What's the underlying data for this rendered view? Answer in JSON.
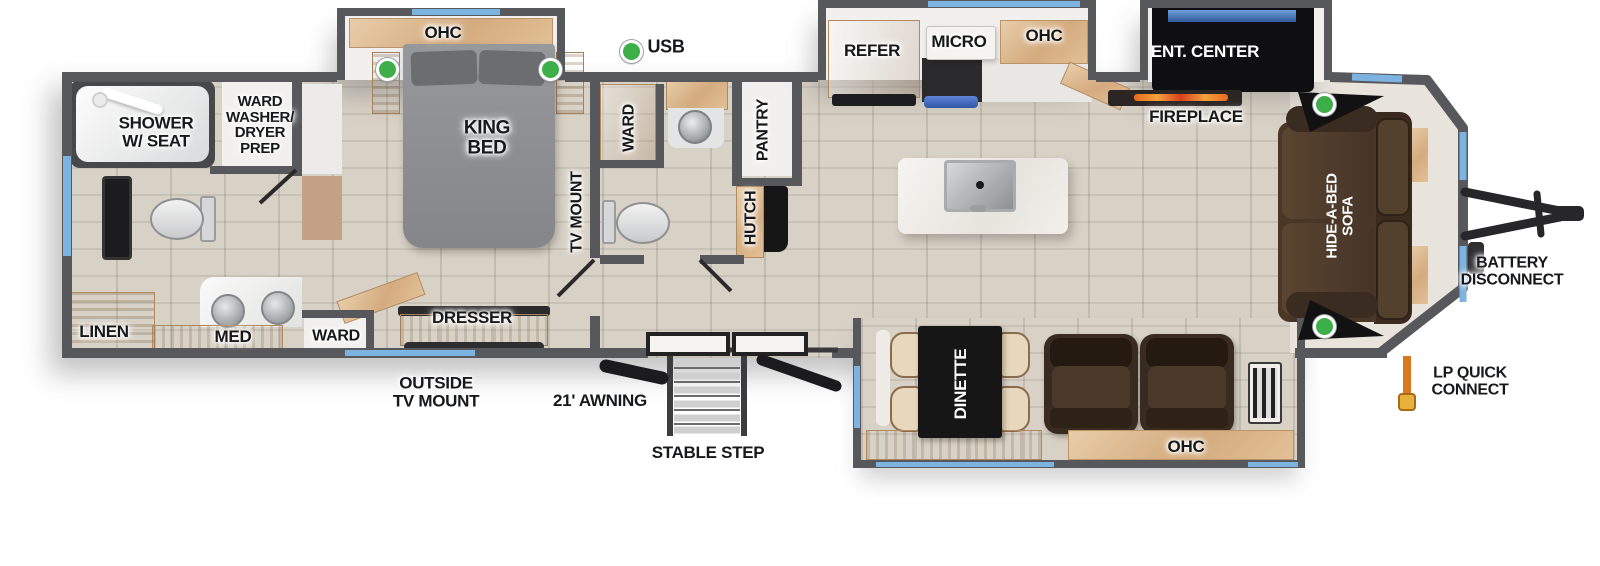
{
  "title": "Travel trailer floor plan",
  "colors": {
    "wall": "#57585b",
    "window": "#7db3e0",
    "usb_green": "#3eae49",
    "wood": "#dcbb97",
    "floor": "#d8d1c5",
    "appliance_black": "#141414",
    "sofa_brown": "#4a3627",
    "flame_orange": "#e86a1e",
    "lp_orange": "#d97820"
  },
  "legend": {
    "usb": "USB"
  },
  "rear_bath": {
    "shower": "SHOWER\nW/ SEAT",
    "ward_prep": "WARD\nWASHER/\nDRYER\nPREP",
    "linen": "LINEN",
    "med": "MED"
  },
  "bedroom": {
    "ohc": "OHC",
    "king_bed": "KING\nBED",
    "tv_mount": "TV MOUNT",
    "ward": "WARD",
    "dresser": "DRESSER"
  },
  "mid_bath": {
    "ward": "WARD",
    "pantry": "PANTRY",
    "hutch": "HUTCH"
  },
  "kitchen": {
    "refer": "REFER",
    "micro": "MICRO",
    "ohc": "OHC"
  },
  "living": {
    "ent_center": "ENT. CENTER",
    "fireplace": "FIREPLACE",
    "sofa": "HIDE-A-BED\nSOFA",
    "dinette": "DINETTE",
    "ohc": "OHC"
  },
  "exterior": {
    "outside_tv_mount": "OUTSIDE\nTV MOUNT",
    "awning": "21' AWNING",
    "stable_step": "STABLE STEP",
    "battery_disconnect": "BATTERY\nDISCONNECT",
    "lp_quick_connect": "LP QUICK\nCONNECT"
  }
}
